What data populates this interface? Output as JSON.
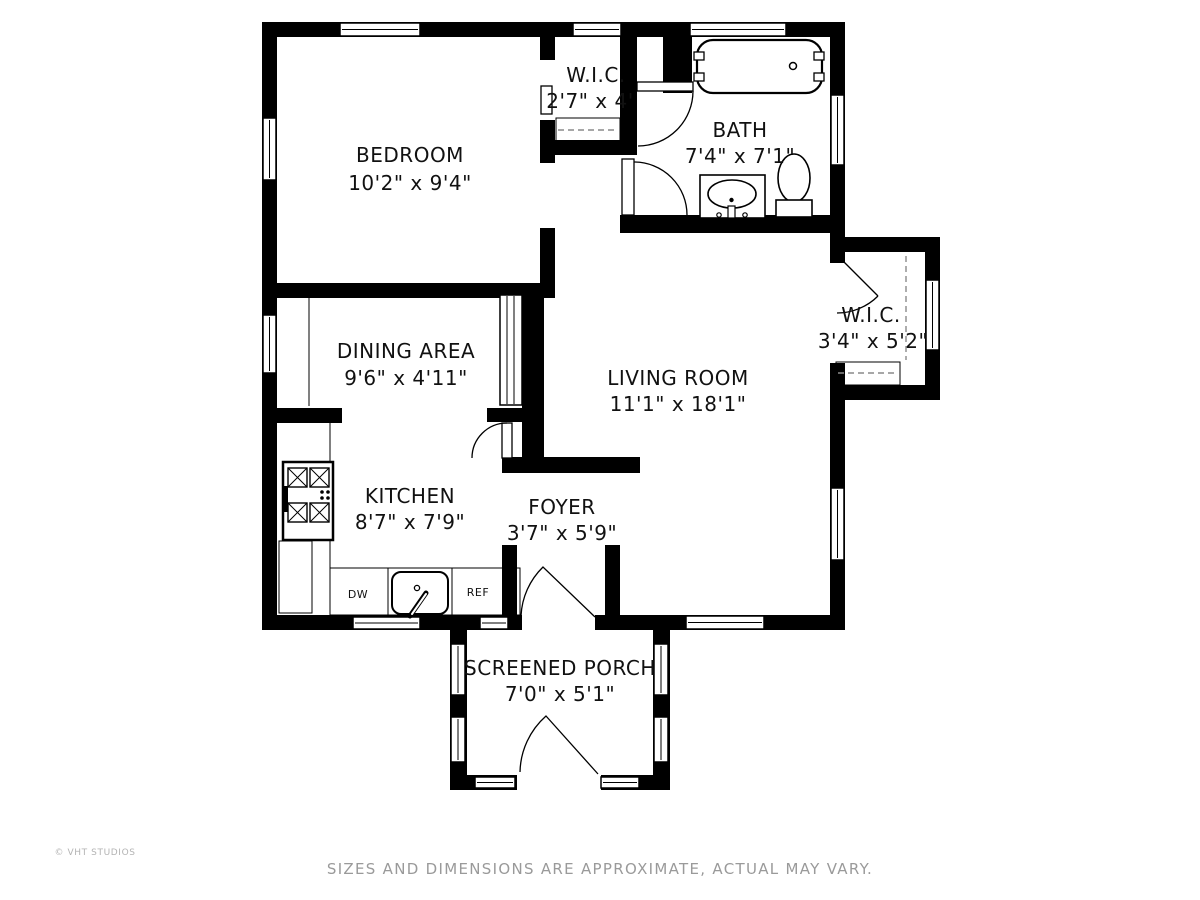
{
  "plan": {
    "rooms": [
      {
        "id": "bedroom",
        "name": "BEDROOM",
        "dims": "10'2\" x 9'4\""
      },
      {
        "id": "wic-top",
        "name": "W.I.C.",
        "dims": "2'7\" x 4'"
      },
      {
        "id": "bath",
        "name": "BATH",
        "dims": "7'4\" x 7'1\""
      },
      {
        "id": "dining",
        "name": "DINING AREA",
        "dims": "9'6\" x 4'11\""
      },
      {
        "id": "living",
        "name": "LIVING ROOM",
        "dims": "11'1\" x 18'1\""
      },
      {
        "id": "wic-right",
        "name": "W.I.C.",
        "dims": "3'4\" x 5'2\""
      },
      {
        "id": "kitchen",
        "name": "KITCHEN",
        "dims": "8'7\" x 7'9\""
      },
      {
        "id": "foyer",
        "name": "FOYER",
        "dims": "3'7\" x 5'9\""
      },
      {
        "id": "porch",
        "name": "SCREENED PORCH",
        "dims": "7'0\" x 5'1\""
      }
    ],
    "appliances": {
      "dishwasher": "DW",
      "refrigerator": "REF"
    }
  },
  "footer": {
    "copyright": "© VHT STUDIOS",
    "disclaimer": "SIZES AND DIMENSIONS ARE APPROXIMATE, ACTUAL MAY VARY."
  },
  "colors": {
    "wall": "#000000",
    "background": "#ffffff",
    "muted_text": "#9a9a9a"
  }
}
